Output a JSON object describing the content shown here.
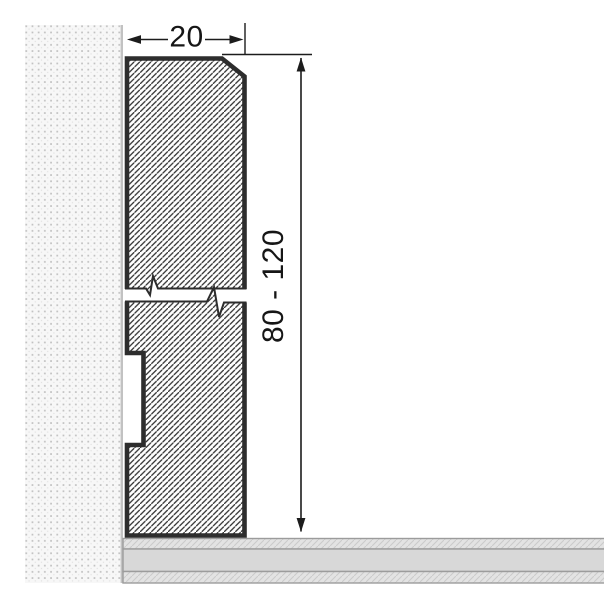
{
  "diagram": {
    "kind": "skirting-board-cross-section",
    "dimension_labels": {
      "width": "20",
      "height": "80 - 120"
    },
    "components": {
      "wall": "stippled wall section (left)",
      "profile": "hatched skirting profile with break symbol and back groove",
      "floor": "three-layer floor section (bottom)"
    },
    "colors": {
      "background": "#ffffff",
      "profile_outline": "#2d2d2d",
      "profile_hatch": "#333333",
      "wall_fill": "#f7f7f7",
      "wall_dot": "#c0c0c0",
      "wall_edge": "#c2c2c2",
      "floor_fill": "#d8d8d8",
      "floor_hatch_fill": "#e3e3e3",
      "floor_edge": "#9c9c9c",
      "dimension_line": "#1c1c1c"
    }
  }
}
